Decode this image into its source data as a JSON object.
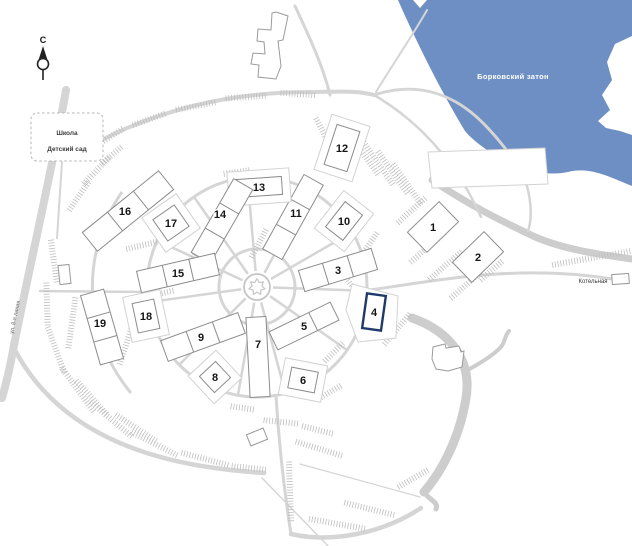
{
  "north": {
    "label": "С"
  },
  "water": {
    "label": "Борковский затон",
    "color": "#6e8fc3",
    "label_color": "#ffffff",
    "path": "M398,0 L413,0 L420,8 L427,0 L632,0 L632,36 L615,44 L607,62 L612,80 L602,95 L610,110 L598,121 L606,128 L620,131 L632,135 L632,186 C612,178 590,166 568,172 C550,176 530,172 508,162 C492,154 475,143 465,131 C445,98 420,50 398,0 Z"
  },
  "facility_box": {
    "lines": [
      "Школа",
      "Детский сад"
    ]
  },
  "street": {
    "label": "ул. 8-я линия"
  },
  "boiler": {
    "label": "Котельная"
  },
  "highlight": {
    "building": "4",
    "color": "#1e3a6a"
  },
  "colors": {
    "road": "#d5d5d5",
    "road_thick": "#cdcdcd",
    "hatch": "#bdbdbd",
    "building_outline": "#8c8c8c",
    "building_fill": "#ffffff",
    "pad_outline": "#d2d2d2",
    "number": "#151515",
    "hub": "#c5c5c5"
  },
  "geometry": {
    "center": {
      "x": 257,
      "y": 287
    },
    "rings": [
      38,
      110
    ],
    "outer_arc": "M122,192 A166,166 0 0 0 131,393",
    "spoke_angles": [
      -155,
      -125,
      -95,
      -62,
      -30,
      2,
      35,
      75,
      100,
      135,
      172
    ],
    "spoke_r": [
      16,
      110
    ],
    "roads": [
      {
        "p": "M412,318 C452,332 472,362 466,398 C460,436 443,470 424,492",
        "w": 9,
        "thick": true
      },
      {
        "p": "M424,492 C430,501 439,502 436,509",
        "w": 5,
        "thick": true
      },
      {
        "p": "M464,372 C481,363 492,356 500,348 C506,342 504,336 509,331",
        "w": 4,
        "thick": true
      },
      {
        "p": "M432,180 C470,206 506,223 533,236 C562,249 596,254 632,259",
        "w": 7,
        "thick": true
      },
      {
        "p": "M66,90 C52,170 32,255 14,345 C10,368 6,384 2,398",
        "w": 8
      },
      {
        "p": "M16,352 C52,418 120,455 215,468 C235,471 250,472 264,473",
        "w": 4.5
      },
      {
        "p": "M62,162 L57,238",
        "w": 2
      },
      {
        "p": "M70,158 C150,108 235,92 310,92 C338,92 356,90 374,95",
        "w": 4
      },
      {
        "p": "M330,95 C322,62 305,28 295,6",
        "w": 3
      },
      {
        "p": "M374,95 C420,80 456,96 483,123 C501,141 513,159 523,173",
        "w": 3
      },
      {
        "p": "M374,95 C410,116 440,146 462,181 C470,194 476,206 481,217",
        "w": 2.5
      },
      {
        "p": "M523,173 C531,196 533,216 528,231",
        "w": 2.5
      },
      {
        "p": "M376,92 C398,56 416,30 427,10",
        "w": 2
      },
      {
        "p": "M370,290 C440,280 520,264 612,279",
        "w": 3
      },
      {
        "p": "M276,396 C279,444 284,490 291,534",
        "w": 3
      },
      {
        "p": "M291,534 C330,543 382,534 421,508",
        "w": 4.5
      },
      {
        "p": "M300,464 L420,497",
        "w": 1.2
      },
      {
        "p": "M262,478 L328,546",
        "w": 1.4
      },
      {
        "p": "M40,291 L148,292",
        "w": 2.5
      }
    ],
    "hatches": [
      [
        110,
        137,
        32,
        -33
      ],
      [
        150,
        119,
        36,
        -20
      ],
      [
        196,
        106,
        40,
        -11
      ],
      [
        246,
        97,
        40,
        -4
      ],
      [
        298,
        94,
        34,
        4
      ],
      [
        363,
        153,
        55,
        55
      ],
      [
        378,
        163,
        55,
        55
      ],
      [
        393,
        173,
        52,
        55
      ],
      [
        407,
        184,
        48,
        55
      ],
      [
        322,
        130,
        26,
        62
      ],
      [
        412,
        210,
        38,
        -42
      ],
      [
        428,
        247,
        46,
        -41
      ],
      [
        446,
        265,
        44,
        -41
      ],
      [
        466,
        285,
        40,
        -41
      ],
      [
        492,
        270,
        30,
        -41
      ],
      [
        592,
        258,
        80,
        -10
      ],
      [
        352,
        286,
        36,
        52
      ],
      [
        398,
        328,
        42,
        -50
      ],
      [
        368,
        246,
        36,
        -55
      ],
      [
        282,
        422,
        36,
        6
      ],
      [
        318,
        430,
        32,
        14
      ],
      [
        243,
        408,
        24,
        8
      ],
      [
        320,
        449,
        50,
        17
      ],
      [
        338,
        524,
        58,
        10
      ],
      [
        370,
        509,
        52,
        14
      ],
      [
        414,
        478,
        36,
        -30
      ],
      [
        290,
        492,
        60,
        88
      ],
      [
        54,
        262,
        44,
        82
      ],
      [
        47,
        305,
        44,
        88
      ],
      [
        56,
        350,
        48,
        70
      ],
      [
        78,
        390,
        54,
        54
      ],
      [
        112,
        420,
        56,
        40
      ],
      [
        155,
        444,
        52,
        27
      ],
      [
        205,
        459,
        48,
        15
      ],
      [
        250,
        468,
        36,
        6
      ],
      [
        92,
        398,
        46,
        48
      ],
      [
        136,
        428,
        48,
        33
      ],
      [
        72,
        322,
        52,
        -82
      ],
      [
        126,
        345,
        40,
        -72
      ],
      [
        152,
        243,
        52,
        -13
      ],
      [
        150,
        296,
        48,
        -13
      ],
      [
        197,
        251,
        32,
        -58
      ],
      [
        259,
        243,
        32,
        -62
      ],
      [
        237,
        172,
        26,
        -8
      ],
      [
        97,
        170,
        38,
        -46
      ],
      [
        79,
        196,
        34,
        -56
      ],
      [
        112,
        155,
        26,
        -40
      ],
      [
        334,
        352,
        26,
        -45
      ],
      [
        330,
        392,
        26,
        -30
      ]
    ],
    "plots": [
      "352,284 398,296 396,338 358,342 346,310",
      "428,152 545,148 548,184 432,188"
    ],
    "outlines": [
      "276,12 288,16 283,40 278,41 281,66 276,79 258,77 259,65 251,64 253,53 265,54 264,42 257,41 258,29 271,30 272,13",
      "433,347 445,344 446,348 459,346 461,352 464,351 462,367 448,371 436,369 432,359"
    ],
    "small_buildings": [
      {
        "x": 59,
        "y": 265,
        "w": 11,
        "h": 19,
        "rot": -6
      },
      {
        "x": 248,
        "y": 431,
        "w": 18,
        "h": 12,
        "rot": -22
      },
      {
        "x": 612,
        "y": 274,
        "w": 17,
        "h": 10,
        "rot": -4
      }
    ]
  },
  "buildings": [
    {
      "label": "1",
      "cx": 433,
      "cy": 227,
      "w": 44,
      "h": 28,
      "rot": -44,
      "divs": []
    },
    {
      "label": "2",
      "cx": 478,
      "cy": 257,
      "w": 44,
      "h": 28,
      "rot": -44,
      "divs": []
    },
    {
      "label": "3",
      "cx": 338,
      "cy": 270,
      "w": 76,
      "h": 22,
      "rot": -17,
      "divs": [
        -0.17,
        0.17
      ]
    },
    {
      "label": "4",
      "cx": 374,
      "cy": 312,
      "w": 19,
      "h": 35,
      "rot": 8,
      "divs": [],
      "highlighted": true
    },
    {
      "label": "5",
      "cx": 304,
      "cy": 326,
      "w": 68,
      "h": 20,
      "rot": -26,
      "divs": [
        0.15
      ]
    },
    {
      "label": "6",
      "cx": 303,
      "cy": 380,
      "w": 27,
      "h": 21,
      "rot": 11,
      "divs": [],
      "pad": true
    },
    {
      "label": "7",
      "cx": 258,
      "cy": 357,
      "w": 20,
      "h": 80,
      "rot": -3,
      "divs": [],
      "lx": 258,
      "ly": 344
    },
    {
      "label": "8",
      "cx": 215,
      "cy": 377,
      "w": 22,
      "h": 22,
      "rot": -43,
      "divs": [],
      "pad": true
    },
    {
      "label": "9",
      "cx": 203,
      "cy": 337,
      "w": 82,
      "h": 22,
      "rot": -20,
      "divs": [
        -0.17,
        0.17
      ],
      "lx": 201,
      "ly": 337
    },
    {
      "label": "10",
      "cx": 344,
      "cy": 221,
      "w": 22,
      "h": 32,
      "rot": 38,
      "divs": [],
      "pad": true
    },
    {
      "label": "11",
      "cx": 293,
      "cy": 217,
      "w": 22,
      "h": 85,
      "rot": 29,
      "divs": [
        -0.17,
        0.17
      ],
      "lx": 296,
      "ly": 213
    },
    {
      "label": "12",
      "cx": 342,
      "cy": 148,
      "w": 24,
      "h": 42,
      "rot": 18,
      "divs": [],
      "pad": true
    },
    {
      "label": "13",
      "cx": 259,
      "cy": 187,
      "w": 46,
      "h": 18,
      "rot": -4,
      "divs": [],
      "pad": true
    },
    {
      "label": "14",
      "cx": 222,
      "cy": 221,
      "w": 22,
      "h": 85,
      "rot": 30,
      "divs": [
        -0.17,
        0.17
      ],
      "lx": 220,
      "ly": 214
    },
    {
      "label": "15",
      "cx": 178,
      "cy": 273,
      "w": 80,
      "h": 22,
      "rot": -13,
      "divs": [
        -0.17,
        0.17
      ]
    },
    {
      "label": "16",
      "cx": 128,
      "cy": 211,
      "w": 98,
      "h": 24,
      "rot": -39,
      "divs": [
        -0.17,
        0.17
      ],
      "lx": 125,
      "ly": 211
    },
    {
      "label": "17",
      "cx": 171,
      "cy": 223,
      "w": 26,
      "h": 26,
      "rot": -35,
      "divs": [],
      "pad": true
    },
    {
      "label": "18",
      "cx": 146,
      "cy": 316,
      "w": 22,
      "h": 30,
      "rot": -12,
      "divs": [],
      "pad": true
    },
    {
      "label": "19",
      "cx": 102,
      "cy": 327,
      "w": 24,
      "h": 72,
      "rot": -16,
      "divs": [
        -0.17,
        0.17
      ],
      "lx": 100,
      "ly": 323
    }
  ]
}
